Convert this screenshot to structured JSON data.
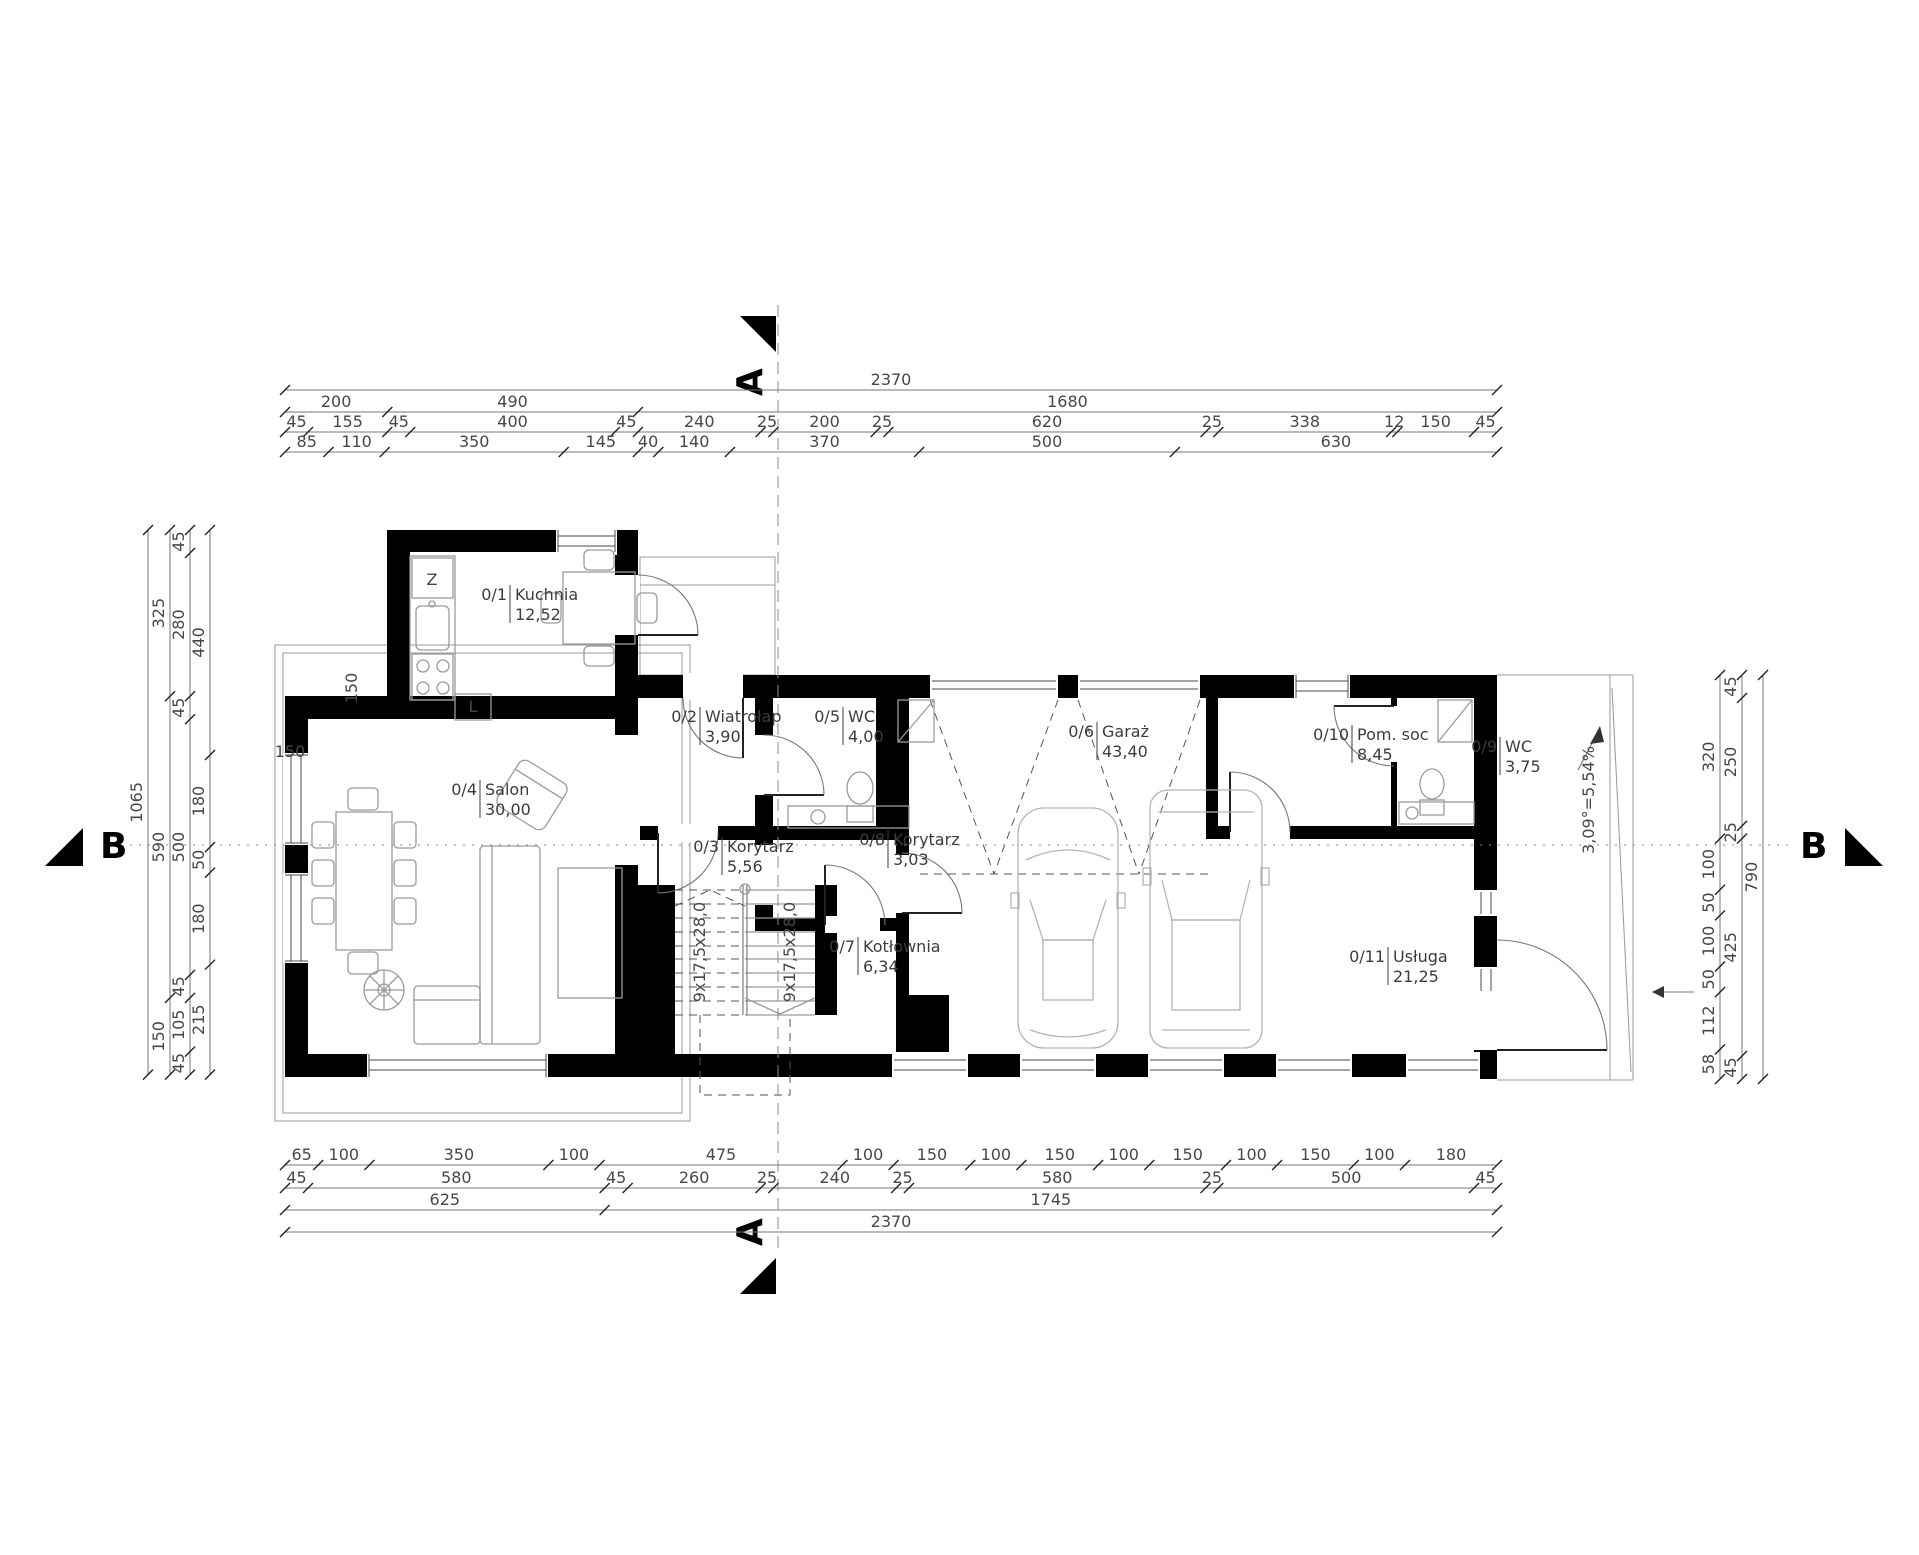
{
  "drawing": {
    "section_marker_a": "A",
    "section_marker_b": "B"
  },
  "rooms": [
    {
      "id": "0/1",
      "name": "Kuchnia",
      "area": "12,52",
      "x": 510,
      "y": 600
    },
    {
      "id": "0/2",
      "name": "Wiatrołap",
      "area": "3,90",
      "x": 700,
      "y": 722
    },
    {
      "id": "0/3",
      "name": "Korytarz",
      "area": "5,56",
      "x": 722,
      "y": 852
    },
    {
      "id": "0/4",
      "name": "Salon",
      "area": "30,00",
      "x": 480,
      "y": 795
    },
    {
      "id": "0/5",
      "name": "WC",
      "area": "4,00",
      "x": 843,
      "y": 722
    },
    {
      "id": "0/6",
      "name": "Garaż",
      "area": "43,40",
      "x": 1097,
      "y": 737
    },
    {
      "id": "0/7",
      "name": "Kotłownia",
      "area": "6,34",
      "x": 858,
      "y": 952
    },
    {
      "id": "0/8",
      "name": "Korytarz",
      "area": "3,03",
      "x": 888,
      "y": 845
    },
    {
      "id": "0/9",
      "name": "WC",
      "area": "3,75",
      "x": 1500,
      "y": 752
    },
    {
      "id": "0/10",
      "name": "Pom. soc",
      "area": "8,45",
      "x": 1352,
      "y": 740
    },
    {
      "id": "0/11",
      "name": "Usługa",
      "area": "21,25",
      "x": 1388,
      "y": 962
    }
  ],
  "dimensions": {
    "scale_px_per_cm": 0.5114,
    "top": {
      "x0": 285,
      "rows": [
        {
          "y": 390,
          "segments": [
            2370
          ]
        },
        {
          "y": 412,
          "segments": [
            200,
            490,
            1680
          ]
        },
        {
          "y": 432,
          "segments": [
            45,
            155,
            45,
            400,
            45,
            240,
            25,
            200,
            25,
            620,
            25,
            338,
            12,
            150,
            45
          ]
        },
        {
          "y": 452,
          "segments": [
            85,
            110,
            350,
            145,
            40,
            140,
            370,
            500,
            630
          ]
        }
      ]
    },
    "bottom": {
      "x0": 285,
      "rows": [
        {
          "y": 1165,
          "segments": [
            65,
            100,
            350,
            100,
            475,
            100,
            150,
            100,
            150,
            100,
            150,
            100,
            150,
            100,
            180
          ]
        },
        {
          "y": 1188,
          "segments": [
            45,
            580,
            45,
            260,
            25,
            240,
            25,
            580,
            25,
            500,
            45
          ]
        },
        {
          "y": 1210,
          "segments": [
            625,
            1745
          ]
        },
        {
          "y": 1232,
          "segments": [
            2370
          ]
        }
      ]
    },
    "left": {
      "y0": 530,
      "cols": [
        {
          "x": 148,
          "segments": [
            1065
          ]
        },
        {
          "x": 170,
          "segments": [
            325,
            590,
            150
          ]
        },
        {
          "x": 190,
          "segments": [
            45,
            280,
            45,
            500,
            45,
            105,
            45
          ]
        },
        {
          "x": 210,
          "segments": [
            440,
            180,
            50,
            180,
            215
          ]
        }
      ]
    },
    "right": {
      "y0": 675,
      "cols": [
        {
          "x": 1720,
          "segments": [
            320,
            100,
            50,
            100,
            50,
            112,
            58
          ]
        },
        {
          "x": 1742,
          "segments": [
            45,
            250,
            25,
            425,
            45
          ]
        },
        {
          "x": 1763,
          "segments": [
            790
          ]
        }
      ]
    }
  },
  "annotations": [
    {
      "text": "Z",
      "x": 432,
      "y": 585,
      "rot": 0,
      "size": 14
    },
    {
      "text": "L",
      "x": 473,
      "y": 712,
      "rot": 0,
      "size": 14
    },
    {
      "text": "9x17,5x28,0",
      "x": 705,
      "y": 952,
      "rot": -90,
      "size": 14
    },
    {
      "text": "9x17,5x28,0",
      "x": 795,
      "y": 952,
      "rot": -90,
      "size": 14
    },
    {
      "text": "3,09°=5,54%",
      "x": 1594,
      "y": 800,
      "rot": -90,
      "size": 15
    },
    {
      "text": "150",
      "x": 290,
      "y": 757,
      "rot": 0,
      "size": 15
    },
    {
      "text": "150",
      "x": 357,
      "y": 688,
      "rot": -90,
      "size": 15
    }
  ]
}
